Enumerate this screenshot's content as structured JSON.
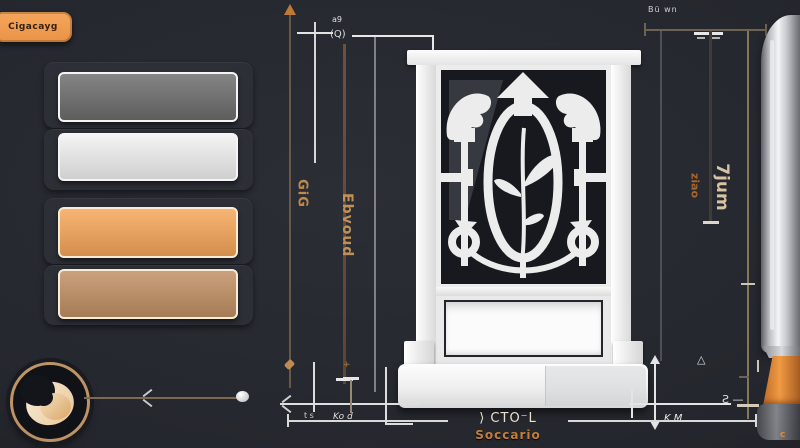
{
  "app": {
    "badge_label": "Cigacayg"
  },
  "palette": {
    "swatches": [
      {
        "name": "slate-gray",
        "color": "#6d6d6d"
      },
      {
        "name": "off-white",
        "color": "#f1f1f1"
      },
      {
        "name": "apricot-orange",
        "color": "#f6a659"
      },
      {
        "name": "bronze-tan",
        "color": "#c19064"
      }
    ]
  },
  "annotations": {
    "left": {
      "outer_label": "GiG",
      "inner_label": "Ebvoud",
      "micro_top_a": "a9",
      "micro_top_b": "(Q)"
    },
    "right": {
      "inner_label": "ziao",
      "outer_label": "7jum",
      "micro_top": "Bü wn",
      "triangle_glyph": "△",
      "micro_km": "K M",
      "micro_s": "Ƨ —",
      "tick_plus": "+"
    },
    "bottom": {
      "micro_left_a": "t s",
      "micro_left_b": "Ko d",
      "width_label": "⟩ CTO⁻L",
      "width_sublabel": "Soccario"
    },
    "pen_mark": "c"
  },
  "colors": {
    "background": "#25272e",
    "accent_orange": "#f2a054",
    "dim_line_brown": "#6a594a",
    "dim_line_white": "#e3e3e3",
    "door_white": "#f0f0f0",
    "label_gold": "#c08a49"
  }
}
